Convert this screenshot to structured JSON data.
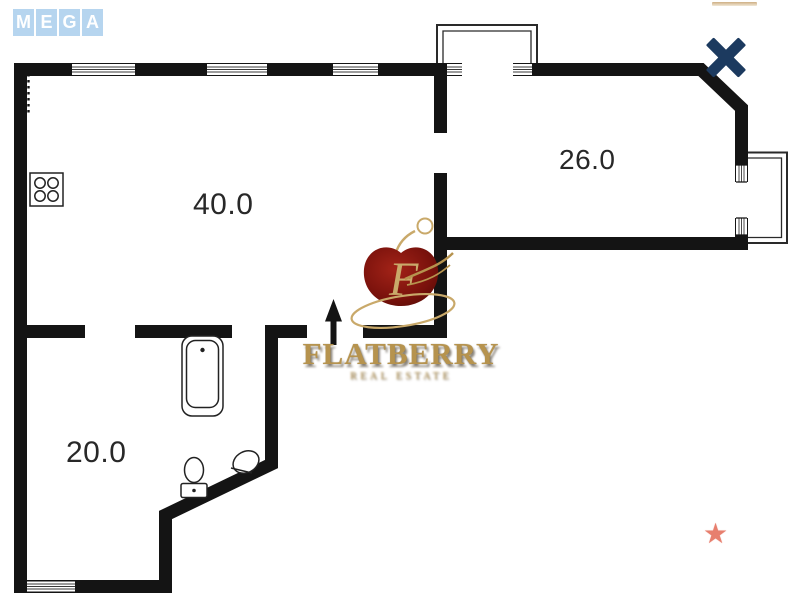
{
  "header": {
    "mega_logo": {
      "letters": [
        "M",
        "E",
        "G",
        "A"
      ]
    },
    "close_button": {
      "name": "close",
      "color": "#1c3a5f"
    }
  },
  "floor_plan": {
    "rooms": [
      {
        "name": "living-room",
        "area": "40.0"
      },
      {
        "name": "bedroom",
        "area": "26.0"
      },
      {
        "name": "second-room",
        "area": "20.0"
      }
    ],
    "fixtures": [
      "stove",
      "bathtub",
      "toilet",
      "sink",
      "entrance-arrow"
    ],
    "features": [
      "top-balcony",
      "right-balcony",
      "windows"
    ],
    "colors": {
      "wall": "#141414",
      "background": "#ffffff"
    }
  },
  "watermark": {
    "brand": "FLATBERRY",
    "monogram": "F",
    "tagline": "REAL ESTATE",
    "colors": {
      "gold": "#b6934e",
      "berry": "#7a120c"
    }
  },
  "decor": {
    "star": {
      "glyph": "★",
      "color": "#e77f6e"
    }
  }
}
